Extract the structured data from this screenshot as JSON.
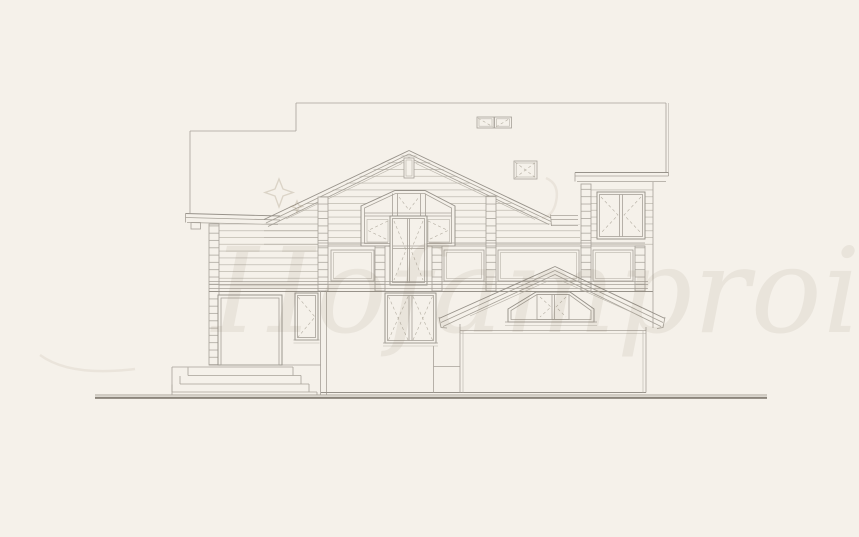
{
  "meta": {
    "description": "Architectural front elevation line drawing of a two-storey log house with central glazed gable, balcony railing, side porch with gabled entrance and exterior steps",
    "view": "front elevation",
    "style": "CAD line drawing on beige paper"
  },
  "canvas": {
    "width": 859,
    "height": 537,
    "background": "#f5f1ea"
  },
  "palette": {
    "line": "#a6a198",
    "line_strong": "#97928a",
    "line_light": "#b8b3a9",
    "dashed_marks": "#b3ada1",
    "ground": "#8b857b",
    "watermark": "#7a6a50"
  },
  "watermark": {
    "text": "Hofamproi",
    "opacity": "0.09",
    "sparkle_star": "four-point star upper left"
  },
  "drawing": {
    "parts": [
      "main roof with stepped ridge line",
      "left porch shed roof",
      "central gable with king post",
      "glazed gable window wall with balcony door",
      "balcony railing with stacked-log posts and panels",
      "horizontal log wall courses",
      "corner log-end columns",
      "right wing with eave band and double window",
      "entrance door under left porch",
      "narrow casement window",
      "double casement window",
      "right gabled entrance porch with lunette window",
      "exterior steps (four treads)",
      "two roof vents / chimney boxes",
      "ground line"
    ]
  }
}
